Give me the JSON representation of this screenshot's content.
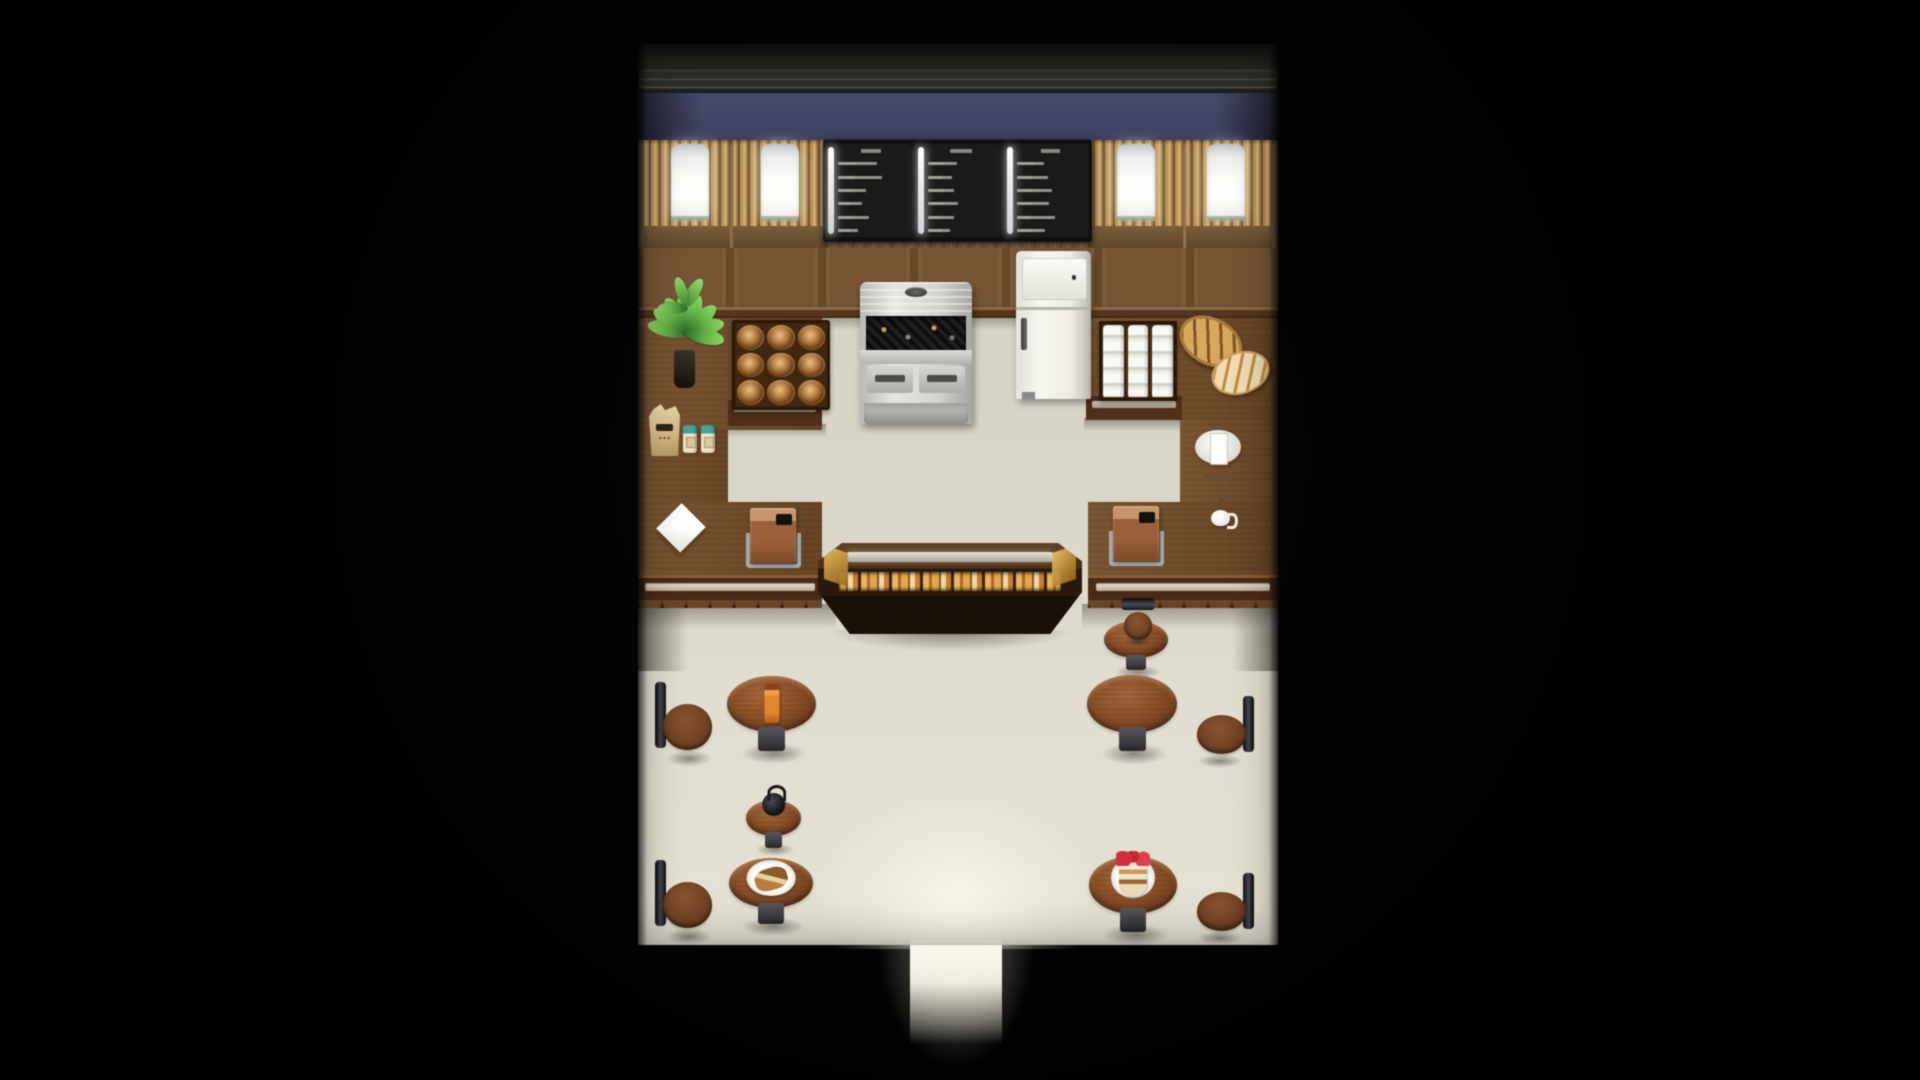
{
  "scene": {
    "kind": "top-down-rpg-interior",
    "room": "bakery-cafe",
    "visible_text": "none (menu board text is sub-pixel and illegible)"
  },
  "palette": {
    "background": "#000000",
    "wall-blue": "#474b6c",
    "floor-kitchen": "#d7d4c5",
    "floor-dining": "#e2decf",
    "counter": "#6f4a28",
    "case-dark": "#2a1a0c",
    "pastry-gold": "#e0a84c",
    "table-wood": "#8a5028",
    "drink": "#e0862e",
    "cake-red": "#c02838",
    "glow": "#fdf8e8"
  },
  "windows": [
    {
      "name": "display-window-1",
      "x": 6,
      "w": 86,
      "pane_x": 27,
      "pane_w": 38
    },
    {
      "name": "display-window-2",
      "x": 95,
      "w": 95,
      "pane_x": 28,
      "pane_w": 38
    },
    {
      "name": "display-window-3",
      "x": 450,
      "w": 95,
      "pane_x": 29,
      "pane_w": 38
    },
    {
      "name": "display-window-4",
      "x": 548,
      "w": 86,
      "pane_x": 21,
      "pane_w": 38
    }
  ],
  "menu_board": {
    "panels": [
      {
        "header_w": 30,
        "rows": [
          {
            "l": 58,
            "r": 28
          },
          {
            "l": 66,
            "r": 26
          },
          {
            "rule": true
          },
          {
            "l": 42,
            "r": 22
          },
          {
            "l": 36,
            "r": 20
          },
          {
            "l": 46,
            "r": 22
          },
          {
            "l": 30,
            "r": 18
          }
        ]
      },
      {
        "header_w": 34,
        "rows": [
          {
            "l": 44,
            "r": 24
          },
          {
            "l": 36,
            "r": 22
          },
          {
            "l": 40,
            "r": 24
          },
          {
            "rule": true
          },
          {
            "l": 46,
            "r": 24
          },
          {
            "l": 40,
            "r": 20
          },
          {
            "l": 34,
            "r": 22
          }
        ]
      },
      {
        "header_w": 28,
        "rows": [
          {
            "l": 40,
            "r": 26
          },
          {
            "l": 46,
            "r": 22
          },
          {
            "l": 52,
            "r": 24
          },
          {
            "rule": true
          },
          {
            "l": 48,
            "r": 22
          },
          {
            "l": 56,
            "r": 20
          },
          {
            "l": 42,
            "r": 24
          }
        ]
      }
    ]
  },
  "furniture": [
    {
      "type": "plant",
      "name": "potted-plant",
      "x": 8,
      "y": 198,
      "w": 76,
      "h": 146,
      "interactable": false
    },
    {
      "type": "rack",
      "name": "pastry-display-rack",
      "x": 94,
      "y": 276,
      "w": 88,
      "h": 80,
      "interactable": true
    },
    {
      "type": "oven",
      "name": "baking-oven",
      "x": 222,
      "y": 238,
      "w": 112,
      "h": 142,
      "interactable": true
    },
    {
      "type": "fridge",
      "name": "refrigerator",
      "x": 378,
      "y": 207,
      "w": 75,
      "h": 148,
      "interactable": true
    },
    {
      "type": "trays",
      "name": "milk-bottle-trays",
      "x": 461,
      "y": 277,
      "w": 70,
      "h": 72,
      "interactable": false
    },
    {
      "type": "loaves",
      "name": "bread-loaves",
      "x": 540,
      "y": 272,
      "w": 92,
      "h": 78,
      "interactable": false
    },
    {
      "type": "sack",
      "name": "flour-sack",
      "x": 11,
      "y": 360,
      "w": 31,
      "h": 52,
      "interactable": false
    },
    {
      "type": "jars",
      "name": "spice-jars",
      "x": 45,
      "y": 381,
      "w": 32,
      "h": 28,
      "interactable": false
    },
    {
      "type": "napkin",
      "name": "napkin-cloth",
      "x": 19,
      "y": 458,
      "w": 52,
      "h": 54,
      "interactable": false
    },
    {
      "type": "register",
      "name": "cash-register-left",
      "x": 110,
      "y": 464,
      "w": 50,
      "h": 60,
      "interactable": true
    },
    {
      "type": "register",
      "name": "cash-register-right",
      "x": 473,
      "y": 462,
      "w": 50,
      "h": 60,
      "interactable": true
    },
    {
      "type": "scale",
      "name": "kitchen-scale",
      "x": 557,
      "y": 377,
      "w": 46,
      "h": 58,
      "interactable": false
    },
    {
      "type": "cup",
      "name": "coffee-cup",
      "x": 571,
      "y": 457,
      "w": 32,
      "h": 30,
      "interactable": false
    },
    {
      "type": "table",
      "name": "dining-table-drink",
      "x": 89,
      "y": 632,
      "w": 89,
      "h": 88,
      "food": "drink",
      "interactable": true
    },
    {
      "type": "table",
      "name": "side-table-coffee-pot",
      "x": 108,
      "y": 756,
      "w": 55,
      "h": 56,
      "food": "pot",
      "interactable": true
    },
    {
      "type": "table",
      "name": "dining-table-pie",
      "x": 91,
      "y": 814,
      "w": 84,
      "h": 78,
      "food": "pie",
      "interactable": true
    },
    {
      "type": "table",
      "name": "side-table-right",
      "x": 466,
      "y": 577,
      "w": 64,
      "h": 58,
      "interactable": true
    },
    {
      "type": "table",
      "name": "dining-table-right",
      "x": 449,
      "y": 631,
      "w": 90,
      "h": 90,
      "interactable": true
    },
    {
      "type": "table",
      "name": "dining-table-cake",
      "x": 451,
      "y": 812,
      "w": 88,
      "h": 90,
      "food": "cake",
      "interactable": true
    },
    {
      "type": "chair",
      "name": "stool-left-upper",
      "x": 16,
      "y": 638,
      "w": 58,
      "h": 85,
      "side": "left",
      "interactable": true
    },
    {
      "type": "chair",
      "name": "stool-left-lower",
      "x": 16,
      "y": 816,
      "w": 58,
      "h": 85,
      "side": "left",
      "interactable": true
    },
    {
      "type": "chair",
      "name": "stool-right-counter",
      "x": 480,
      "y": 554,
      "w": 40,
      "h": 48,
      "side": "top",
      "interactable": true
    },
    {
      "type": "chair",
      "name": "stool-right-upper",
      "x": 559,
      "y": 652,
      "w": 58,
      "h": 72,
      "side": "right",
      "interactable": true
    },
    {
      "type": "chair",
      "name": "stool-right-lower",
      "x": 559,
      "y": 829,
      "w": 58,
      "h": 72,
      "side": "right",
      "interactable": true
    }
  ],
  "entrance": {
    "name": "entrance-doorway",
    "interactable": true
  }
}
